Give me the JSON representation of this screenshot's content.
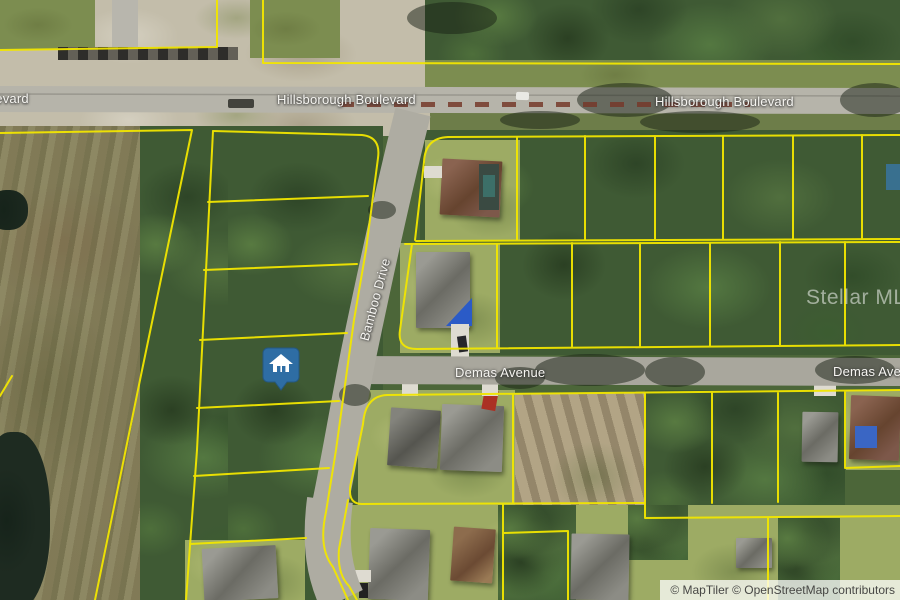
{
  "map": {
    "type": "satellite-parcel-map",
    "streets": {
      "hillsborough_left": "Hillsborough Boulevard",
      "hillsborough_center": "Hillsborough Boulevard",
      "hillsborough_right": "Hillsborough Boulevard",
      "bamboo": "Bamboo Drive",
      "demas_center": "Demas Avenue",
      "demas_right": "Demas Avenue"
    },
    "watermark": "Stellar MLS",
    "attribution": "© MapTiler © OpenStreetMap contributors",
    "marker": {
      "label": "property-location",
      "icon": "house-icon",
      "color": "#2E6DA4"
    },
    "overlay": {
      "parcel_line_color": "#F2E600"
    }
  }
}
